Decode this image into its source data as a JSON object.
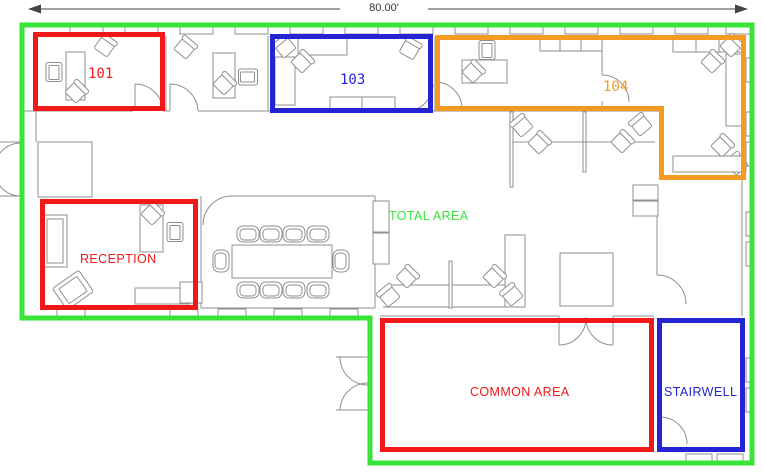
{
  "dimension": {
    "width_label": "80.00'"
  },
  "regions": {
    "total_area": {
      "label": "TOTAL AREA",
      "color": "#38E438"
    },
    "room_101": {
      "label": "101",
      "color": "#F01818"
    },
    "room_103": {
      "label": "103",
      "color": "#2424D2"
    },
    "room_104": {
      "label": "104",
      "color": "#F59B22"
    },
    "reception": {
      "label": "RECEPTION",
      "color": "#F01818"
    },
    "common_area": {
      "label": "COMMON AREA",
      "color": "#F01818"
    },
    "stairwell": {
      "label": "STAIRWELL",
      "color": "#2424D2"
    }
  }
}
